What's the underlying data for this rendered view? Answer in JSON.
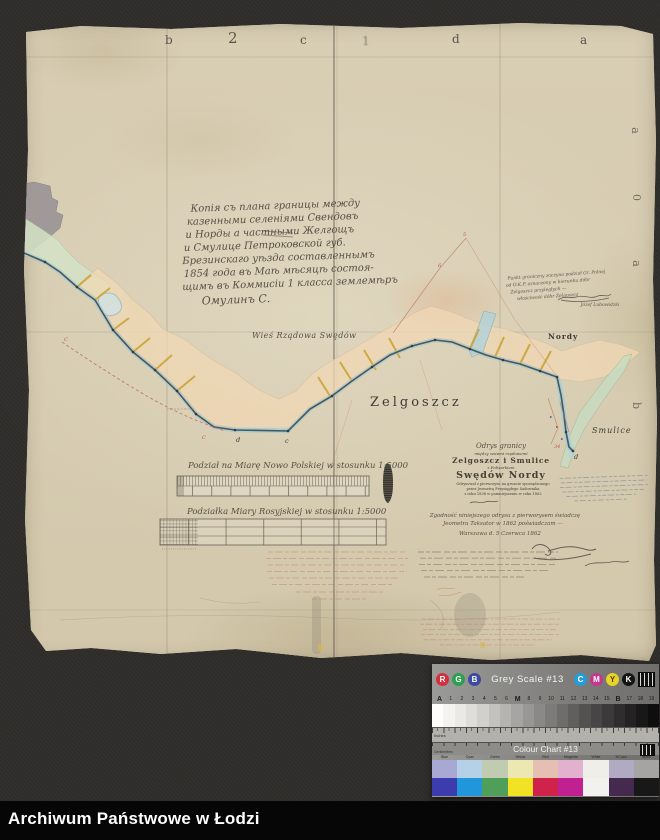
{
  "window": {
    "footer_bar": "Archiwum Państwowe w Łodzi"
  },
  "map": {
    "margin_letters_top": [
      "b",
      "2",
      "c",
      "1",
      "d",
      "a"
    ],
    "margin_letters_right": [
      "a",
      "0",
      "a",
      "b"
    ],
    "central_inscription": {
      "lines": [
        "Копія съ плана границы между",
        "казенными селеніями Свендовъ",
        "и Норды а частными Желгощъ",
        "и Смулице Петроковской губ.",
        "Брезинскаго уѣзда составленнымъ",
        "1854 года въ Маѣ мѣсяцѣ состоя-",
        "щимъ въ Коммисіи 1 класса землемѣръ"
      ],
      "signature": "Омулинъ С."
    },
    "corner_note": {
      "lines": [
        "Punkt graniczny zaczyna podział Gr. Polnej",
        "od O.K.P. oznaczony w kierunku dóbr",
        "Żelgoszcz przyległych —",
        "właściwość dóbr Żelgoszcz"
      ],
      "signature": "Józef Lubowidzki"
    },
    "village_label": "Wieś Rządowa Swędów",
    "place_labels": {
      "zelgoszcz": "Zelgoszcz",
      "nordy": "Nordy",
      "smulice": "Smulice"
    },
    "boundary_point_letters": {
      "d1": "d",
      "c1": "c",
      "d2": "d"
    },
    "red_marks": {
      "c_upper": "C",
      "c_lower": "C",
      "n5": "5",
      "n6": "6",
      "n34": "34"
    },
    "title_block": {
      "heading_script": "Odrys granicy",
      "sub1": "między wsiami rządowemi",
      "villages": "Zelgoszcz i Smulice",
      "sub2": "z Folwarkiem",
      "estate": "Swędów Nordy",
      "note1": "Odrysował z pierworysu na gruncie sporządzonego",
      "note2": "przez Jeometrę Przysięgłego Sadownika",
      "note3": "z roku 1838 w pomniejszeniu w roku 1862",
      "attest1": "Zgodność niniejszego odrysu z pierworysem świadczę",
      "attest2": "Jeometra Taksator w 1862 poświadczam —",
      "date_line": "Warszawa d. 5 Czerwca 1862"
    },
    "scale_bars": {
      "polish_label": "Podział na Miarę Nowo Polskiej w stosunku 1:5000",
      "russian_label": "Podziałka Miary Rosyjskiej w stosunku 1:5000"
    }
  },
  "calibration": {
    "grey_scale": {
      "title": "Grey Scale #13",
      "rgb_letters": [
        "R",
        "G",
        "B"
      ],
      "rgb_colors": [
        "#d32f3f",
        "#2e9e50",
        "#3c4aa2"
      ],
      "cmyk_letters": [
        "C",
        "M",
        "Y",
        "K"
      ],
      "cmyk_colors": [
        "#239cd8",
        "#c43790",
        "#e8d326",
        "#141414"
      ],
      "scale_labels": [
        "A",
        "1",
        "2",
        "3",
        "4",
        "5",
        "6",
        "M",
        "8",
        "9",
        "10",
        "11",
        "12",
        "13",
        "14",
        "15",
        "B",
        "17",
        "18",
        "19"
      ],
      "patches": [
        "#fcfcfa",
        "#f4f3ef",
        "#ebe9e5",
        "#dfddd9",
        "#d2d0cd",
        "#c4c2bf",
        "#b6b4b1",
        "#a7a5a3",
        "#999795",
        "#8b8987",
        "#7d7b79",
        "#6f6d6b",
        "#615f5e",
        "#545251",
        "#474545",
        "#3b3939",
        "#2f2d2d",
        "#242222",
        "#191818",
        "#0f0e0e"
      ],
      "ruler_label": "Inches"
    },
    "colour_chart": {
      "title": "Colour Chart #13",
      "ruler_label": "Centimetres",
      "labels": [
        "Blue",
        "Cyan",
        "Green",
        "Yellow",
        "Red",
        "Magenta",
        "White",
        "3/Color",
        "Black"
      ],
      "pastel": [
        "#a9a7d4",
        "#b4d1e7",
        "#c0cbb1",
        "#ebe8b2",
        "#e5bfb1",
        "#e1b1ce",
        "#f0eee8",
        "#b1aac3",
        "#a5a4a2"
      ],
      "saturated": [
        "#3c3cae",
        "#2196db",
        "#4f9e5a",
        "#f1e224",
        "#cf234b",
        "#c12091",
        "#f3f1ed",
        "#45294f",
        "#181818"
      ]
    }
  }
}
